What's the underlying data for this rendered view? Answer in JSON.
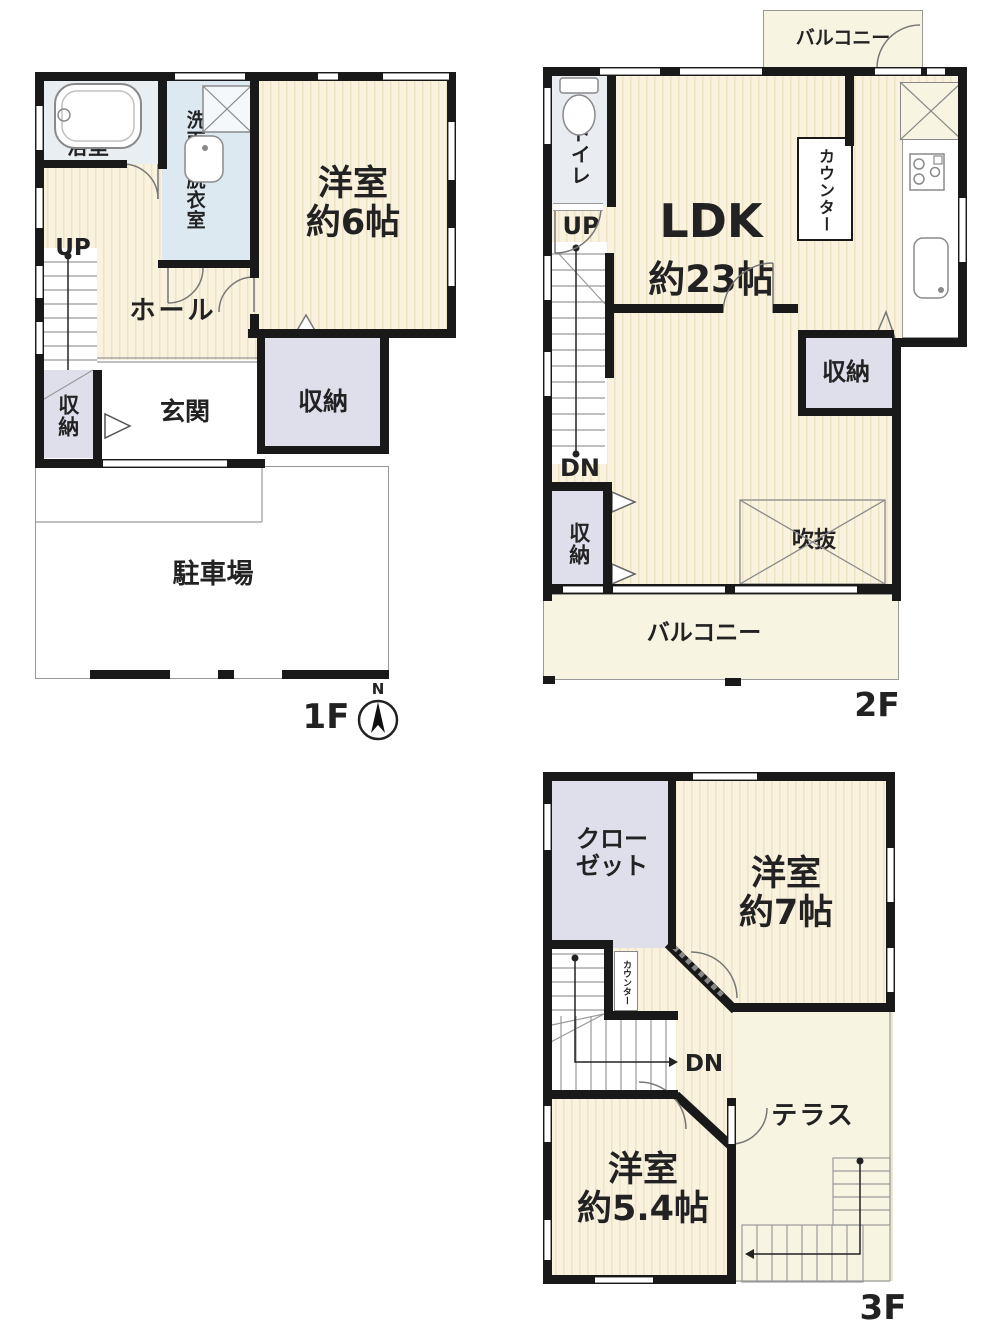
{
  "title": "3-story house floor plan",
  "colors": {
    "wall": "#191919",
    "tatami_base": "#f9f2df",
    "tatami_stripe": "#efe3c6",
    "storage_lavender": "#dfdfec",
    "washroom_blue": "#dde9f1",
    "bath_blue": "#e9eef3",
    "balcony_cream": "#f8f4e2",
    "background": "#ffffff"
  },
  "floors": {
    "f1": {
      "floor_label": "1F",
      "compass_n": "N",
      "bath": "浴室",
      "washroom": "洗面所脱衣室",
      "bedroom6_l1": "洋室",
      "bedroom6_l2": "約6帖",
      "up": "UP",
      "hall": "ホール",
      "storage_left": "収納",
      "entrance": "玄関",
      "storage_right": "収納",
      "parking": "駐車場"
    },
    "f2": {
      "floor_label": "2F",
      "balcony_top": "バルコニー",
      "toilet": "トイレ",
      "up": "UP",
      "dn": "DN",
      "ldk_l1": "LDK",
      "ldk_l2": "約23帖",
      "counter": "カウンター",
      "storage_left": "収納",
      "storage_right": "収納",
      "void_label": "吹抜",
      "balcony_bottom": "バルコニー"
    },
    "f3": {
      "floor_label": "3F",
      "closet_l1": "クロー",
      "closet_l2": "ゼット",
      "bedroom7_l1": "洋室",
      "bedroom7_l2": "約7帖",
      "counter": "カウンター",
      "dn": "DN",
      "terrace": "テラス",
      "bedroom54_l1": "洋室",
      "bedroom54_l2": "約5.4帖"
    }
  }
}
